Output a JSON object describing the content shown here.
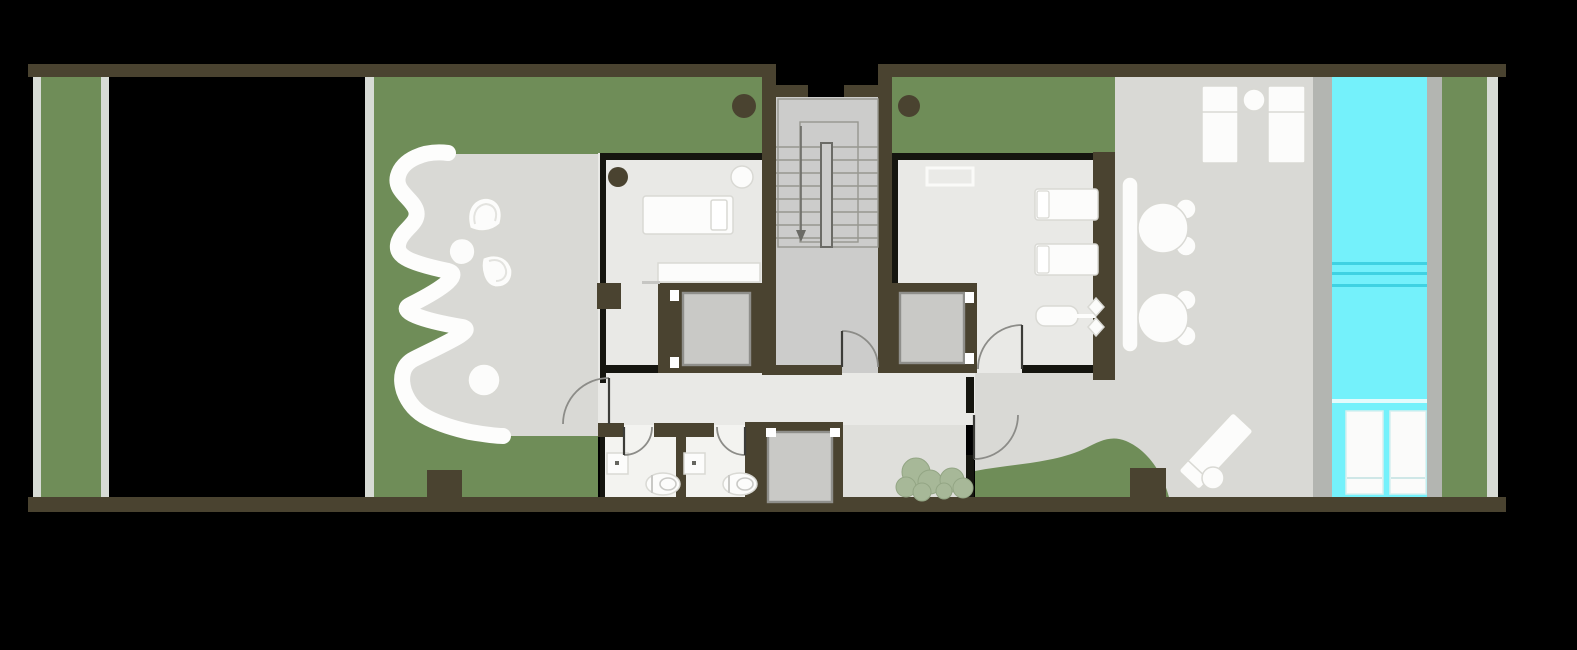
{
  "canvas": {
    "width": 1577,
    "height": 650,
    "background": "#000000"
  },
  "scene": {
    "kind": "architectural-floor-plan",
    "view": "top-down",
    "visible_text": "none"
  },
  "palette": {
    "bg": "#000000",
    "wall": "#4a4330",
    "innerwall": "#15150f",
    "garden": "#6f8d58",
    "terrace": "#d9d9d5",
    "floor": "#e9e9e6",
    "bathfloor": "#f3f3f0",
    "corridor": "#dfdfdb",
    "stair": "#cccccb",
    "stairline": "#97978f",
    "stairrail": "#6b6b66",
    "car": "#c9c9c6",
    "carline": "#8f8f8b",
    "pool": "#74f1fb",
    "poolline": "#3fd2e2",
    "pooldivider": "#e4fbfc",
    "deck": "#b3b5b1",
    "strip": "#d7dbd5",
    "white": "#fcfcfb",
    "whiteline": "#d9d9d4",
    "shrub": "#a7b898",
    "shrubline": "#93a584",
    "arc": "#8c8c88",
    "leaf": "#3c3c38",
    "ledge": "#c6c6c3",
    "fixturedot": "#666660"
  },
  "inventory": {
    "zones": [
      {
        "id": "left-planter-strip",
        "surface": "garden"
      },
      {
        "id": "west-garden",
        "surface": "garden",
        "features": [
          "organic-white-path",
          "two-fan-chairs",
          "stone-seat",
          "round-table",
          "stone-terrace",
          "column"
        ]
      },
      {
        "id": "bedroom",
        "furniture": [
          "single-bed",
          "desk",
          "round-side-table",
          "planter-pot"
        ]
      },
      {
        "id": "stair-core",
        "features": [
          "u-shaped-stair",
          "down-arrow",
          "top-entry"
        ]
      },
      {
        "id": "spa-gym-room",
        "furniture": [
          "wall-bench",
          "massage-lounger",
          "massage-lounger",
          "exercise-machine"
        ]
      },
      {
        "id": "bathroom-1",
        "fixtures": [
          "sink",
          "toilet"
        ]
      },
      {
        "id": "bathroom-2",
        "fixtures": [
          "sink",
          "toilet"
        ]
      },
      {
        "id": "corridor",
        "features": [
          "two-shrubs"
        ]
      },
      {
        "id": "east-terrace",
        "furniture": [
          "sun-lounger",
          "sun-lounger",
          "round-side-table",
          "long-bench",
          "cafe-table-with-two-chairs",
          "cafe-table-with-two-chairs",
          "diagonal-lounger",
          "round-side-table"
        ]
      },
      {
        "id": "lap-pool",
        "features": [
          "lane-lines",
          "shallow-step",
          "in-pool-lounger",
          "in-pool-lounger"
        ]
      },
      {
        "id": "east-garden",
        "surface": "garden"
      }
    ],
    "counts": {
      "elevators": 3,
      "door-arcs": 6,
      "trees-dark": 2,
      "shrubs": 2
    }
  }
}
